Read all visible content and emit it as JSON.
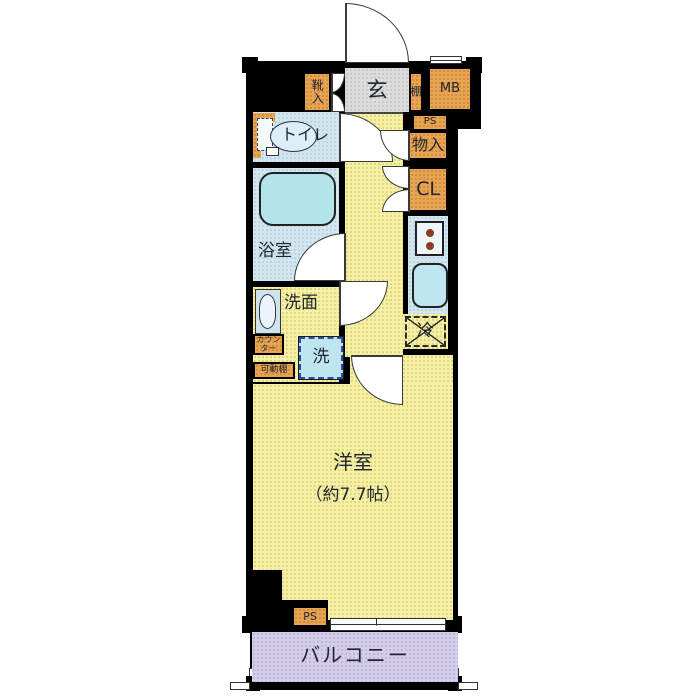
{
  "labels": {
    "entrance": "玄",
    "shoe_cabinet": "靴入",
    "shelf_top": "棚",
    "meter_box": "MB",
    "pipe_space_top": "PS",
    "storage": "物入",
    "closet": "CL",
    "toilet": "トイレ",
    "bathroom": "浴室",
    "washroom": "洗面",
    "counter_line1": "カウン",
    "counter_line2": "ター",
    "movable_shelf": "可動棚",
    "washing_machine": "洗",
    "refrigerator": "冷",
    "main_room": "洋室",
    "main_room_size": "（約7.7帖）",
    "balcony": "バルコニー",
    "pipe_space_bottom": "PS"
  },
  "colors": {
    "wall": "#000000",
    "floor_yellow": "#f6f0a2",
    "wet_area_blue": "#d3e6ef",
    "bathtub_blue": "#b2e4ea",
    "fixture_blue": "#bfe4f2",
    "storage_orange": "#e8a455",
    "entrance_gray": "#dcdcdc",
    "balcony_purple": "#d5cdea",
    "burner_brown": "#8a3b20",
    "text": "#1f2430"
  }
}
